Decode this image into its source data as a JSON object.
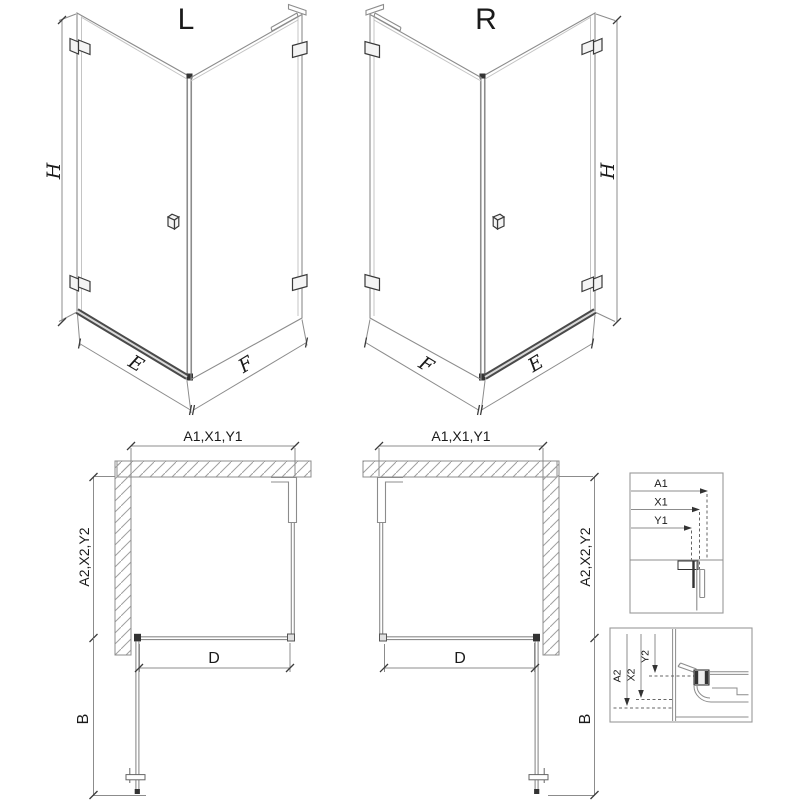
{
  "views": {
    "iso_left": {
      "variant": "L",
      "height_dim": "H",
      "door_dim": "E",
      "panel_dim": "F"
    },
    "iso_right": {
      "variant": "R",
      "height_dim": "H",
      "door_dim": "E",
      "panel_dim": "F"
    },
    "plan_left": {
      "width_dim": "A1,X1,Y1",
      "depth_dim": "A2,X2,Y2",
      "clear_width_dim": "D",
      "door_swing_dim": "B"
    },
    "plan_right": {
      "width_dim": "A1,X1,Y1",
      "depth_dim": "A2,X2,Y2",
      "clear_width_dim": "D",
      "door_swing_dim": "B"
    },
    "detail_width": {
      "dim_a": "A1",
      "dim_x": "X1",
      "dim_y": "Y1"
    },
    "detail_depth": {
      "dim_a": "A2",
      "dim_x": "X2",
      "dim_y": "Y2"
    }
  },
  "colors": {
    "line": "#8c8c8c",
    "dark": "#333333",
    "text": "#1a1a1a",
    "hatch": "#a0a0a0"
  }
}
